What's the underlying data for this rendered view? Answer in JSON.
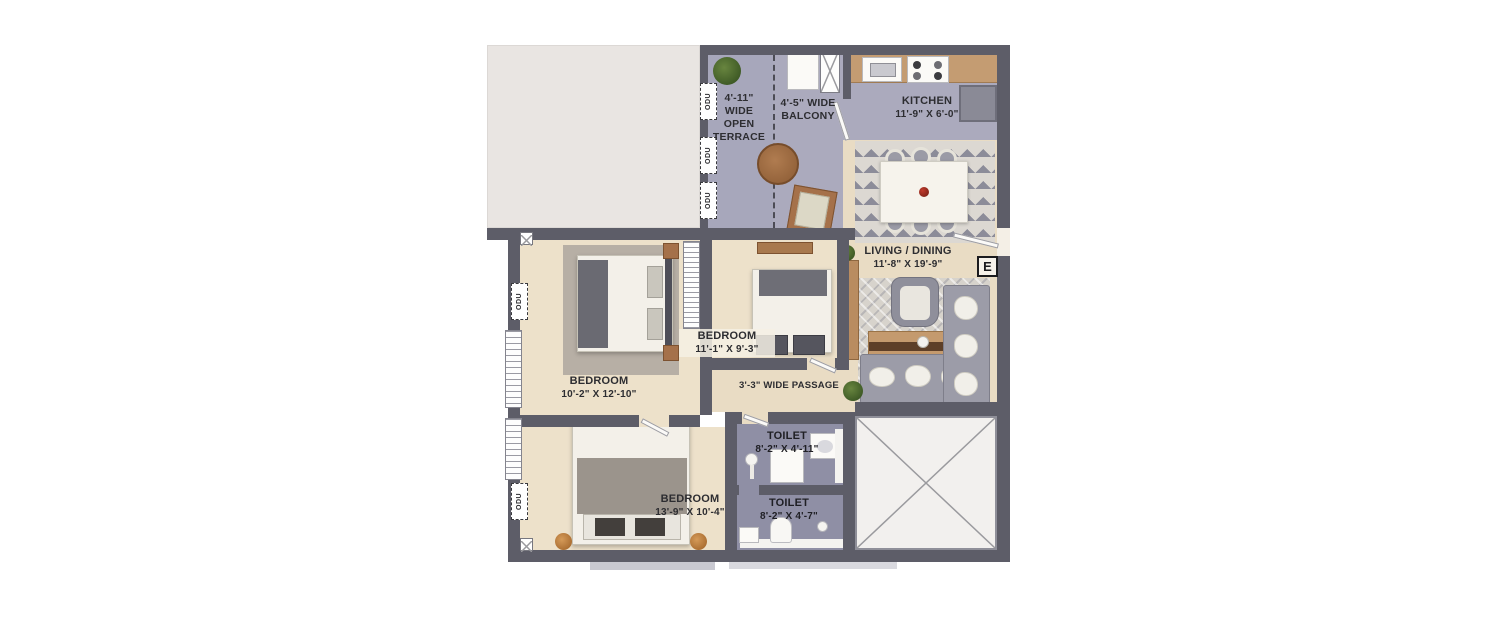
{
  "plan": {
    "terrace": {
      "l1": "4'-11\"",
      "l2": "WIDE",
      "l3": "OPEN",
      "l4": "TERRACE"
    },
    "balcony": {
      "l1": "4'-5\" WIDE",
      "l2": "BALCONY"
    },
    "kitchen": {
      "name": "KITCHEN",
      "dims": "11'-9\" X 6'-0\""
    },
    "living": {
      "name": "LIVING / DINING",
      "dims": "11'-8\" X 19'-9\""
    },
    "bedroom_left": {
      "name": "BEDROOM",
      "dims": "10'-2\" X 12'-10\""
    },
    "bedroom_mid": {
      "name": "BEDROOM",
      "dims": "11'-1\" X 9'-3\""
    },
    "bedroom_bottom": {
      "name": "BEDROOM",
      "dims": "13'-9\" X 10'-4\""
    },
    "toilet_top": {
      "name": "TOILET",
      "dims": "8'-2\" X 4'-11\""
    },
    "toilet_bottom": {
      "name": "TOILET",
      "dims": "8'-2\" X 4'-7\""
    },
    "passage": {
      "name": "3'-3\" WIDE PASSAGE"
    },
    "entrance": {
      "letter": "E"
    },
    "odu": {
      "label": "ODU"
    }
  },
  "colors": {
    "wall": "#5d5d68",
    "floor_beige": "#e9dcc4",
    "floor_lavender": "#a7a7bb",
    "floor_toilet": "#8f8fa5",
    "counter_tan": "#c49c72",
    "outside_gray": "#e9e5e2"
  }
}
